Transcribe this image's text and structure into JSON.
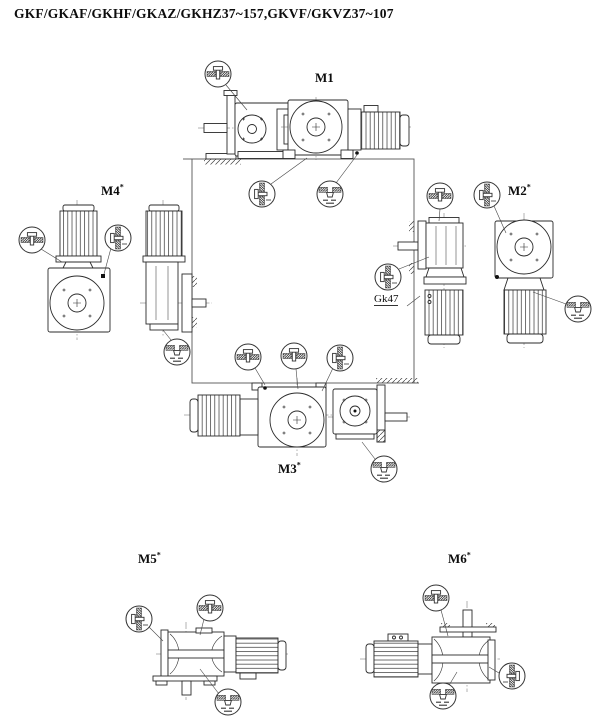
{
  "title": "GKF/GKAF/GKHF/GKAZ/GKHZ37~157,GKVF/GKVZ37~107",
  "mounting_positions": {
    "m1": {
      "label": "M1",
      "sup": ""
    },
    "m2": {
      "label": "M2",
      "sup": "*"
    },
    "m3": {
      "label": "M3",
      "sup": "*"
    },
    "m4": {
      "label": "M4",
      "sup": "*"
    },
    "m5": {
      "label": "M5",
      "sup": "*"
    },
    "m6": {
      "label": "M6",
      "sup": "*"
    }
  },
  "annotations": {
    "gearbox_ref": "Gk47"
  },
  "icons": {
    "vent_plug": "vent-plug-symbol",
    "oil_level_plug": "oil-level-plug-symbol",
    "oil_drain_plug": "oil-drain-plug-symbol"
  },
  "colors": {
    "line": "#2b2b2b",
    "centerline": "#666666",
    "background": "#ffffff"
  }
}
